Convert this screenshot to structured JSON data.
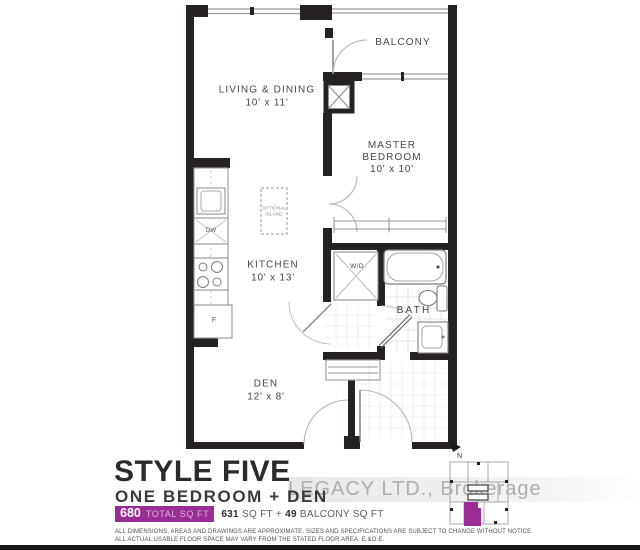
{
  "palette": {
    "accent": "#992d95",
    "wall": "#262223",
    "thin_line": "#9a9a9a"
  },
  "floor_plan": {
    "labels": {
      "living": {
        "name": "LIVING & DINING",
        "dims": "10' x 11'"
      },
      "balcony": {
        "name": "BALCONY"
      },
      "master": {
        "name_line1": "MASTER",
        "name_line2": "BEDROOM",
        "dims": "10' x 10'"
      },
      "kitchen": {
        "name": "KITCHEN",
        "dims": "10' x 13'"
      },
      "den": {
        "name": "DEN",
        "dims": "12' x 8'"
      },
      "bath": {
        "name": "BATH"
      },
      "washer_dryer": {
        "name": "W/D"
      },
      "dishwasher": {
        "name": "DW"
      },
      "fridge": {
        "name": "F"
      },
      "island": {
        "line1": "OPTIONAL",
        "line2": "ISLAND"
      }
    },
    "north_indicator": {
      "label": "N"
    }
  },
  "title_block": {
    "style_name": "STYLE FIVE",
    "unit_type": "ONE BEDROOM + DEN",
    "total_area_badge": {
      "value": "680",
      "unit": "TOTAL SQ FT"
    },
    "area_breakdown": {
      "interior": "631",
      "interior_unit": "SQ FT",
      "separator": "+",
      "balcony": "49",
      "balcony_unit": "BALCONY SQ FT"
    }
  },
  "watermark": {
    "text": "LEGACY LTD., Brokerage"
  },
  "disclaimer": {
    "line1": "ALL DIMENSIONS, AREAS AND DRAWINGS ARE APPROXIMATE. SIZES AND SPECIFICATIONS ARE SUBJECT TO CHANGE WITHOUT NOTICE.",
    "line2": "ALL ACTUAL USABLE FLOOR SPACE MAY VARY FROM THE STATED FLOOR AREA. E.&O.E."
  }
}
